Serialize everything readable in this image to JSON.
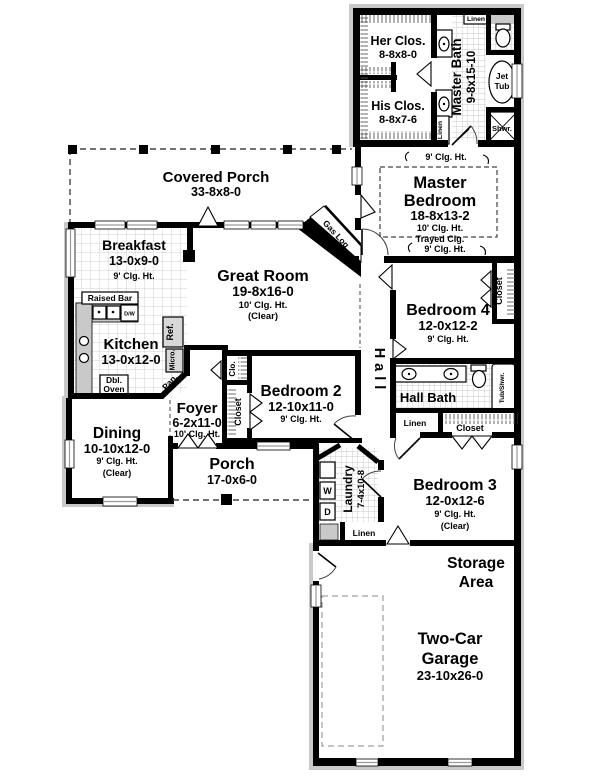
{
  "rooms": {
    "covered_porch": {
      "name": "Covered Porch",
      "dims": "33-8x8-0"
    },
    "her_closet": {
      "name": "Her Clos.",
      "dims": "8-8x8-0"
    },
    "his_closet": {
      "name": "His Clos.",
      "dims": "8-8x7-6"
    },
    "master_bath": {
      "name": "Master Bath",
      "dims": "9-8x15-10"
    },
    "master_bedroom": {
      "line1": "Master",
      "line2": "Bedroom",
      "dims": "18-8x13-2",
      "note1": "10' Clg. Ht.",
      "note2": "Trayed Clg."
    },
    "breakfast": {
      "name": "Breakfast",
      "dims": "13-0x9-0",
      "note1": "9' Clg. Ht."
    },
    "great_room": {
      "name": "Great Room",
      "dims": "19-8x16-0",
      "note1": "10' Clg. Ht.",
      "note2": "(Clear)"
    },
    "kitchen": {
      "name": "Kitchen",
      "dims": "13-0x12-0"
    },
    "dining": {
      "name": "Dining",
      "dims": "10-10x12-0",
      "note1": "9' Clg. Ht.",
      "note2": "(Clear)"
    },
    "foyer": {
      "name": "Foyer",
      "dims": "6-2x11-0",
      "note1": "10' Clg. Ht."
    },
    "porch": {
      "name": "Porch",
      "dims": "17-0x6-0"
    },
    "bedroom2": {
      "name": "Bedroom 2",
      "dims": "12-10x11-0",
      "note1": "9' Clg. Ht."
    },
    "bedroom3": {
      "name": "Bedroom 3",
      "dims": "12-0x12-6",
      "note1": "9' Clg. Ht.",
      "note2": "(Clear)"
    },
    "bedroom4": {
      "name": "Bedroom 4",
      "dims": "12-0x12-2",
      "note1": "9' Clg. Ht."
    },
    "hall": {
      "name": "Hall"
    },
    "hall_bath": {
      "name": "Hall Bath"
    },
    "laundry": {
      "name": "Laundry",
      "dims": "7-4x10-8"
    },
    "storage": {
      "line1": "Storage",
      "line2": "Area"
    },
    "garage": {
      "line1": "Two-Car",
      "line2": "Garage",
      "dims": "23-10x26-0"
    }
  },
  "fixtures": {
    "jet_tub_line1": "Jet",
    "jet_tub_line2": "Tub",
    "shower": "Shwr.",
    "linen": "Linen",
    "raised_bar": "Raised Bar",
    "dishwasher": "D/W",
    "refrigerator": "Ref.",
    "microwave": "Micro.",
    "pantry": "Pan.",
    "dbl_oven_line1": "Dbl.",
    "dbl_oven_line2": "Oven",
    "gas_log": "Gas Log",
    "washer": "W",
    "dryer": "D",
    "tub_shower": "Tub/Shwr.",
    "closet": "Closet",
    "closet_abbr": "Clo."
  },
  "annotations": {
    "ceiling_9": "9' Clg. Ht."
  },
  "colors": {
    "wall": "#000000",
    "counter": "#c9c9c9",
    "background": "#ffffff"
  }
}
